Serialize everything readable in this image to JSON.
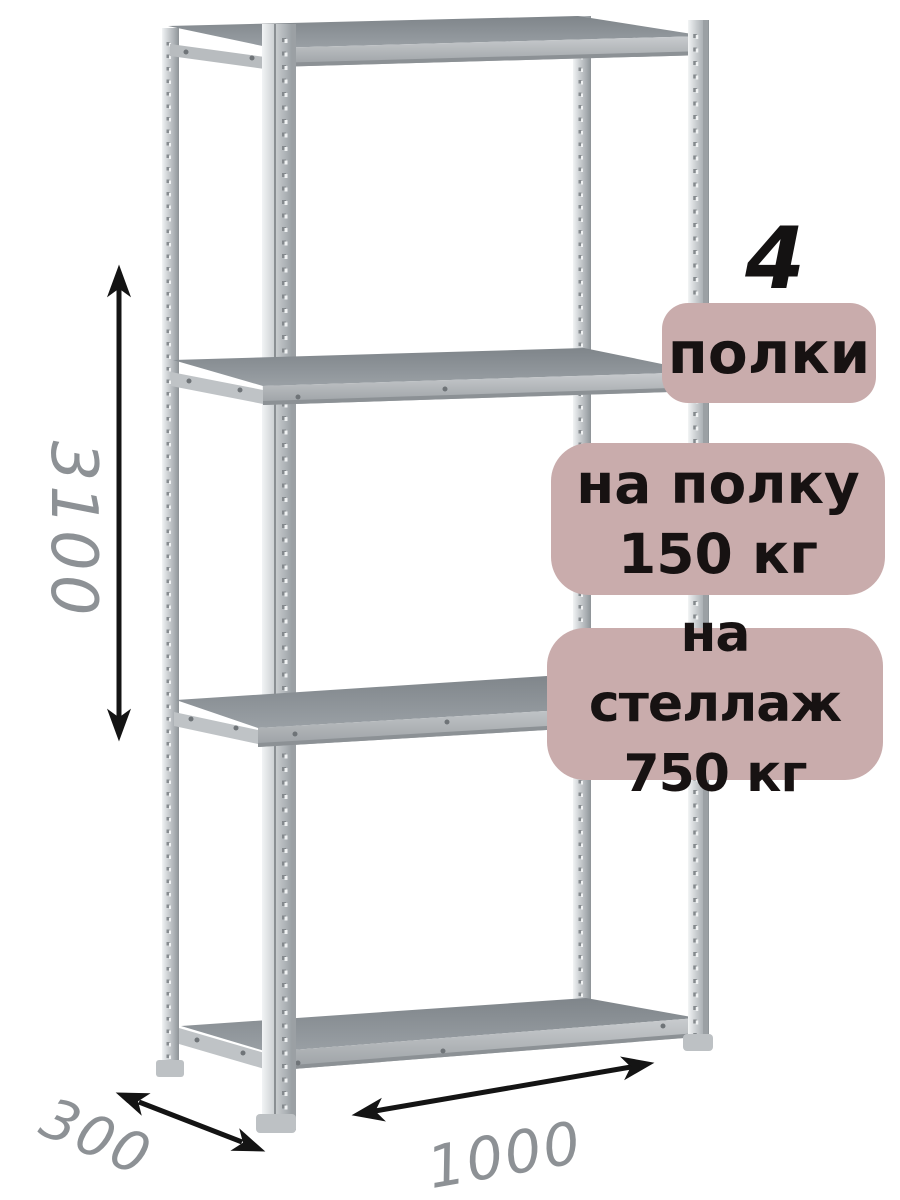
{
  "annotations": {
    "shelf_count_number": "4",
    "shelf_count_label": "полки",
    "shelf_load_line1": "на полку",
    "shelf_load_line2": "150 кг",
    "rack_load_line1": "на стеллаж",
    "rack_load_line2": "750 кг"
  },
  "dimensions": {
    "height": "3100",
    "depth": "300",
    "width": "1000"
  },
  "icons": {
    "height_arrow": "double-headed-vertical-arrow",
    "depth_arrow": "double-headed-diagonal-arrow",
    "width_arrow": "double-headed-diagonal-arrow"
  },
  "colors": {
    "background": "#ffffff",
    "badge_background": "#c9acac",
    "badge_text": "#171212",
    "dimension_text": "#8d9195",
    "arrow": "#141414",
    "metal_light": "#d6dadd",
    "metal_dark": "#8e9397",
    "shelf_surface": "#8f9498"
  },
  "structure": {
    "shelves_shown": 4,
    "posts_shown": 4
  }
}
